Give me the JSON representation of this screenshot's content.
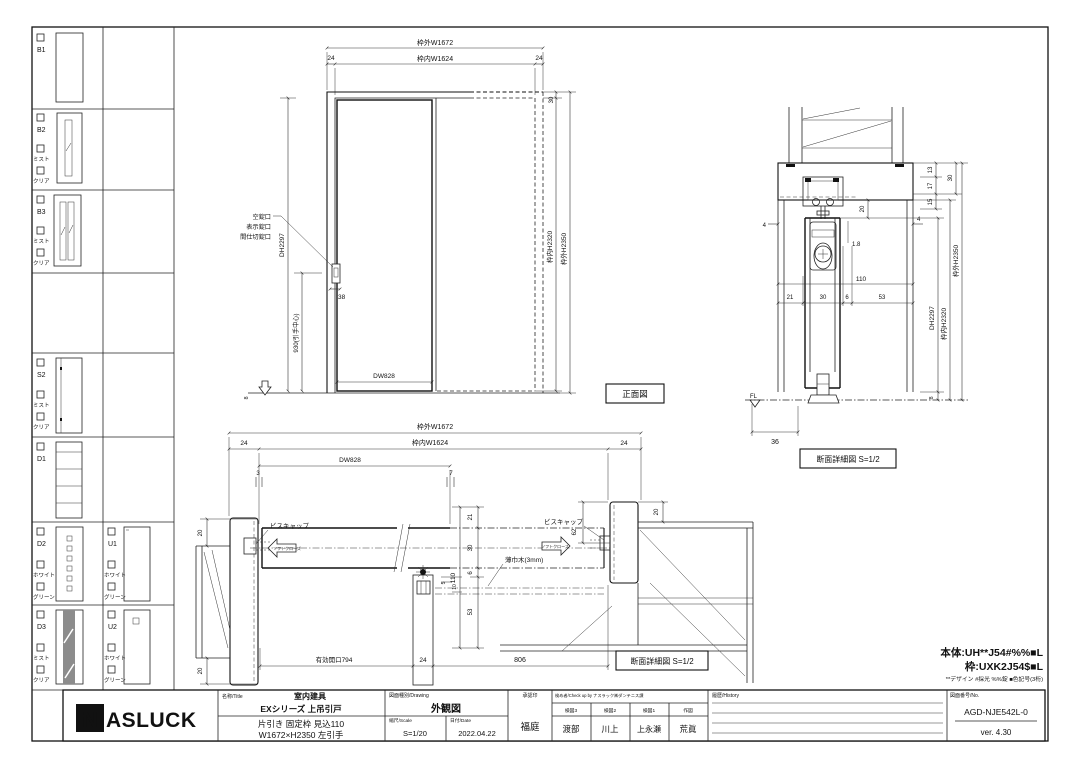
{
  "sidebar": {
    "rows": [
      {
        "id": "B1"
      },
      {
        "id": "B2",
        "opt1": "ミスト",
        "opt2": "クリア"
      },
      {
        "id": "B3",
        "opt1": "ミスト",
        "opt2": "クリア"
      },
      {
        "id": "S2",
        "opt1": "ミスト",
        "opt2": "クリア"
      },
      {
        "id": "D1"
      },
      {
        "id": "D2",
        "opt1": "ホワイト",
        "opt2": "グリーン"
      },
      {
        "id": "D3",
        "opt1": "ミスト",
        "opt2": "クリア"
      },
      {
        "id": "U1",
        "opt1": "ホワイト",
        "opt2": "グリーン"
      },
      {
        "id": "U2",
        "opt1": "ホワイト",
        "opt2": "グリーン"
      }
    ]
  },
  "front": {
    "title": "正面図",
    "w_out": "枠外W1672",
    "w_in": "枠内W1624",
    "m24l": "24",
    "m24r": "24",
    "m30": "30",
    "h_in": "枠内H2320",
    "h_out": "枠外H2350",
    "dh": "DH2297",
    "handle": "930(引手中心)",
    "m38": "38",
    "m8": "8",
    "dw": "DW828",
    "lock1": "空錠口",
    "lock2": "表示錠口",
    "lock3": "間仕切錠口"
  },
  "vsec": {
    "title": "断面詳細図 S=1/2",
    "m13": "13",
    "m17": "17",
    "m15": "15",
    "m30": "30",
    "m4l": "4",
    "m4r": "4",
    "m20": "20",
    "m1_8": "1.8",
    "m110": "110",
    "m21": "21",
    "m30b": "30",
    "m6": "6",
    "m53": "53",
    "dh": "DH2297",
    "h_in": "枠内H2320",
    "h_out": "枠外H2350",
    "m8": "8",
    "m36": "36",
    "fl": "FL"
  },
  "hsec": {
    "title": "断面詳細図 S=1/2",
    "w_out": "枠外W1672",
    "w_in": "枠内W1624",
    "m24l": "24",
    "m24r": "24",
    "dw": "DW828",
    "m3": "3",
    "m7": "7",
    "m20tl": "20",
    "m20bl": "20",
    "m20r": "20",
    "m21": "21",
    "m30": "30",
    "m6": "6",
    "m53": "53",
    "m110": "110",
    "m5": "5",
    "m10": "10",
    "m62": "62",
    "cap_l": "ビスキャップ",
    "cap_r": "ビスキャップ",
    "soft_l": "ソフトクローズ",
    "soft_r": "ソフトクローズ",
    "skirting": "薄巾木(3mm)",
    "opening": "有効開口794",
    "m24b": "24",
    "m806": "806"
  },
  "notes": {
    "body": "本体:UH**J54#%%■L",
    "frame": "枠:UXK2J54$■L",
    "legend": "**デザイン #採光 %%錠 ■色記号(3桁)"
  },
  "titleblock": {
    "logo_n": "N",
    "logo_rest": "ASLUCK",
    "name_header": "名称/Title",
    "name1": "室内建具",
    "name2": "EXシリーズ 上吊引戸",
    "spec1": "片引き 固定枠 見込110",
    "spec2": "W1672×H2350 左引手",
    "drawing_header": "図面種別/Drawing",
    "drawing_type": "外観図",
    "scale_header": "縮尺/Scale",
    "scale": "S=1/20",
    "date_header": "日付/Date",
    "date": "2022.04.22",
    "approval_header": "承認印",
    "approval": "福庭",
    "check_header": "検め者/Check up by ナスラック㈱ダンテニス課",
    "checks": [
      {
        "role": "検図3",
        "name": "渡部"
      },
      {
        "role": "検図2",
        "name": "川上"
      },
      {
        "role": "検図1",
        "name": "上永瀬"
      },
      {
        "role": "作図",
        "name": "荒眞"
      }
    ],
    "history_header": "履歴/History",
    "no_header": "図面番号/No.",
    "drawing_no": "AGD-NJE542L-0",
    "version": "ver. 4.30"
  }
}
